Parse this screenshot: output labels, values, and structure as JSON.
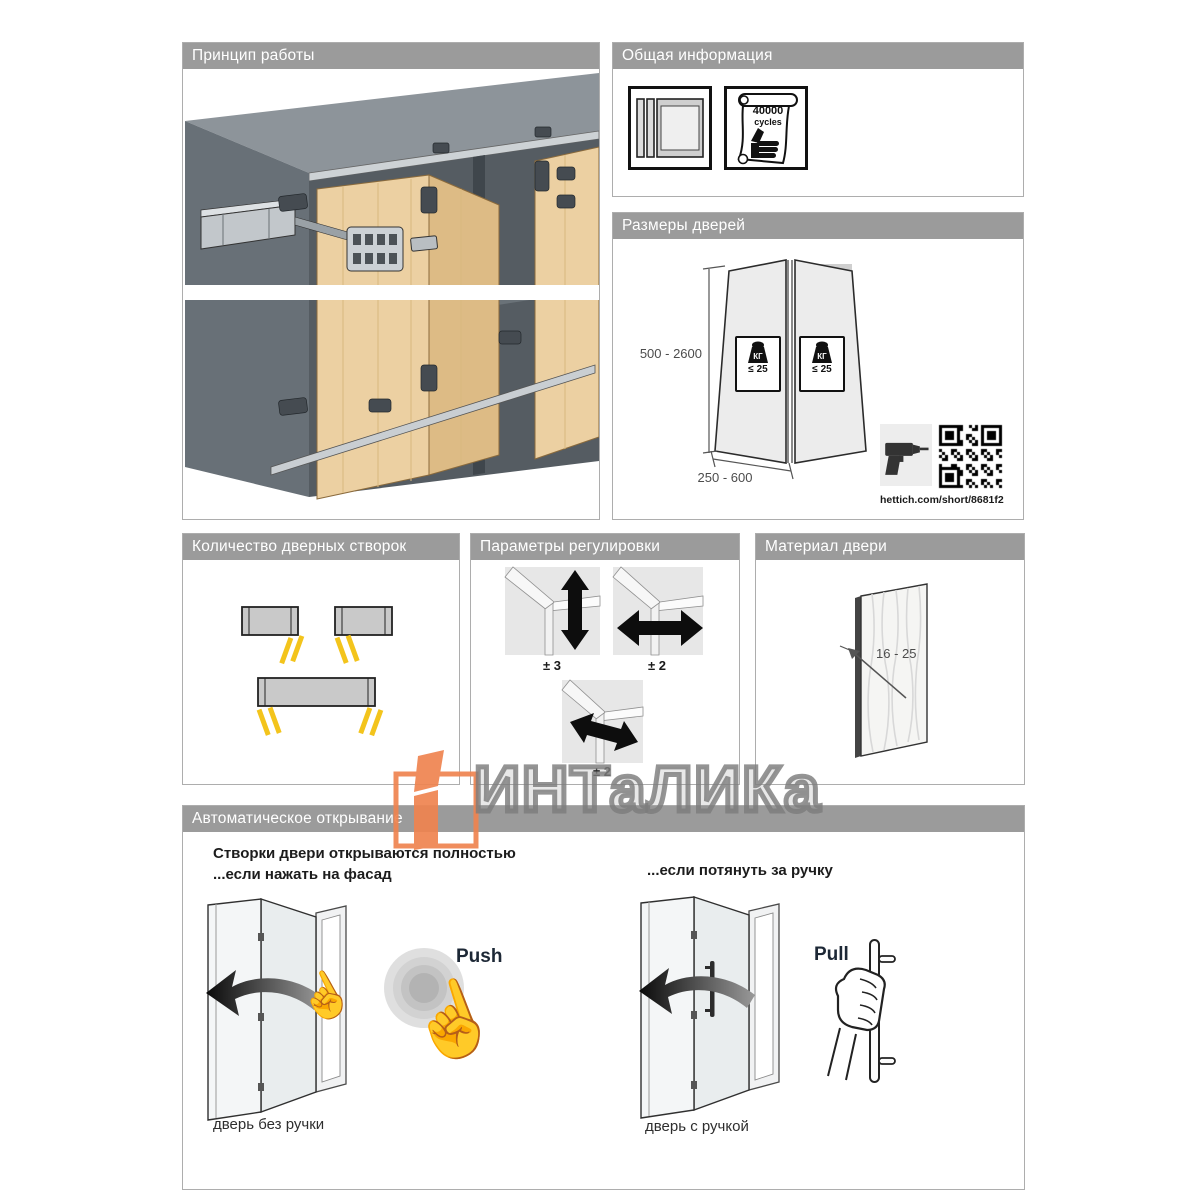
{
  "watermark": {
    "text": "ИНТаЛИКа"
  },
  "icons": {
    "pointing_hand": "☝"
  },
  "colors": {
    "header_gray": "#9b9b9b",
    "accent_orange": "#ef8450",
    "highlight_yellow": "#f3c41c",
    "wood": "#ecd0a2"
  },
  "panel_principle": {
    "title": "Принцип работы"
  },
  "panel_general": {
    "title": "Общая информация",
    "cycles_line1": "40000",
    "cycles_line2": "cycles"
  },
  "panel_sizes": {
    "title": "Размеры дверей",
    "height_range": "500 - 2600",
    "width_range": "250 - 600",
    "weight_unit": "КГ",
    "weight_limit": "≤ 25",
    "qr_link": "hettich.com/short/8681f2"
  },
  "panel_count": {
    "title": "Количество дверных створок"
  },
  "panel_adjust": {
    "title": "Параметры регулировки",
    "vertical": "± 3",
    "horizontal": "± 2",
    "depth": "± 2"
  },
  "panel_material": {
    "title": "Материал двери",
    "thickness": "16 - 25"
  },
  "panel_auto": {
    "title": "Автоматическое открывание",
    "intro_line1": "Створки двери открываются полностью",
    "intro_line2": "...если нажать на фасад",
    "pull_intro": "...если потянуть за ручку",
    "push_label": "Push",
    "pull_label": "Pull",
    "push_caption": "дверь без ручки",
    "pull_caption": "дверь с ручкой"
  }
}
